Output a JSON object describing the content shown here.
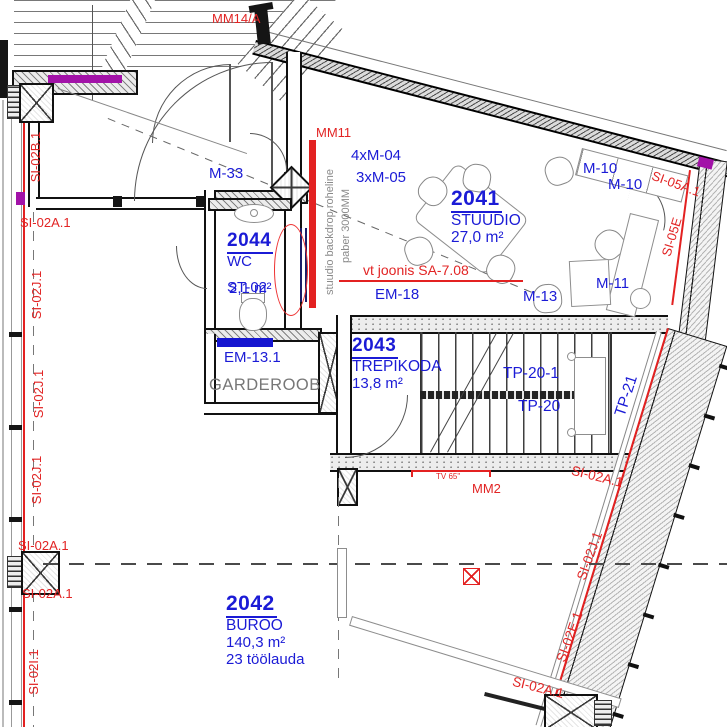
{
  "colors": {
    "label_blue": "#1b1bd6",
    "annotation_red": "#e22424",
    "magenta": "#a212a8",
    "wall": "#151515",
    "gray_text": "#8a8a8a"
  },
  "rooms": {
    "studio": {
      "number": "2041",
      "name": "STUUDIO",
      "area": "27,0 m²"
    },
    "wc": {
      "number": "2044",
      "name": "WC",
      "area": "2,1 m²",
      "code_overlap": "ST-02"
    },
    "stairs": {
      "number": "2043",
      "name": "TREPIKODA",
      "area": "13,8 m²"
    },
    "office": {
      "number": "2042",
      "name": "BÜROO",
      "area": "140,3 m²",
      "desks": "23 töölauda"
    },
    "cloakroom": {
      "name": "GARDEROOB"
    }
  },
  "equipment": {
    "m33": "M-33",
    "m04": "4xM-04",
    "m05": "3xM-05",
    "m10_upper": "M-10",
    "m10_lower": "M-10",
    "m11": "M-11",
    "m13": "M-13",
    "em18": "EM-18",
    "em131": "EM-13.1",
    "tp201": "TP-20-1",
    "tp20": "TP-20",
    "tp21": "TP-21"
  },
  "red": {
    "mm14": "MM14/A",
    "mm11": "MM11",
    "mm2": "MM2",
    "tv": "TV 65\"",
    "vt_joonis": "vt joonis SA-7.08",
    "si05a": "SI-05A.1",
    "si05e": "SI-05E",
    "si02b1": "SI-02B.1",
    "si02a1": "SI-02A.1",
    "si02j1": "SI-02J.1",
    "si02i1": "SI-02I.1",
    "si02e1": "SI-02E.1"
  },
  "notes": {
    "backdrop_line1": "stuudio backdrop roheline",
    "backdrop_line2": "paber 3000MM"
  }
}
